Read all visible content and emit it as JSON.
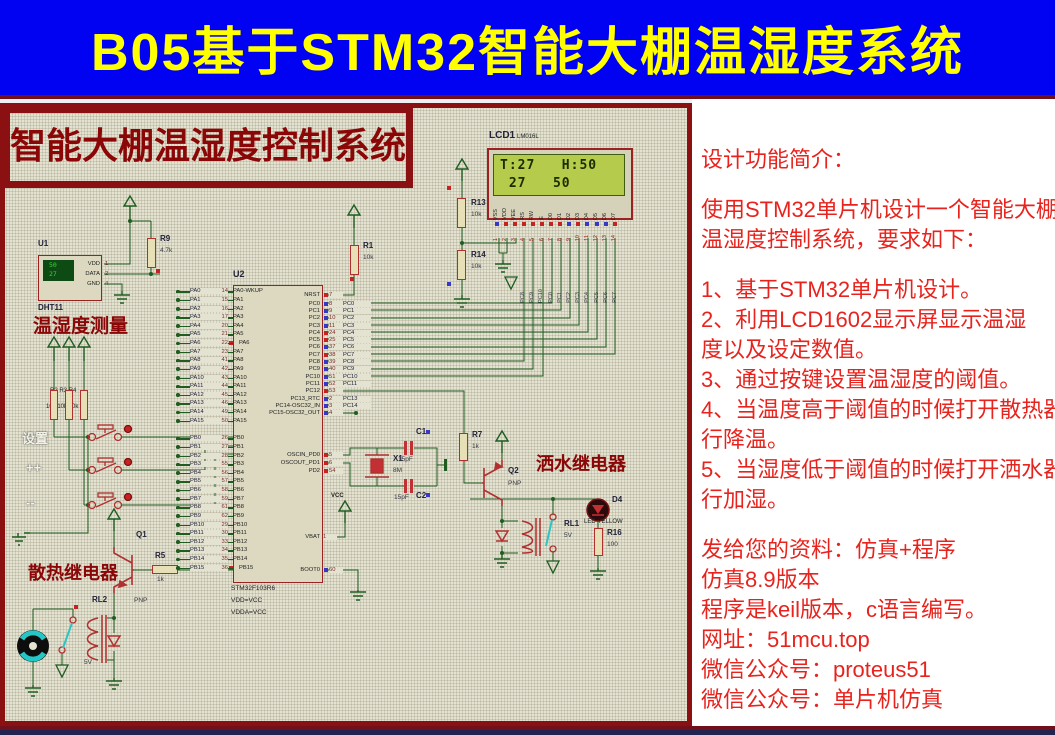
{
  "banner": {
    "title": "B05基于STM32智能大棚温湿度系统"
  },
  "colors": {
    "banner_bg": "#0202f2",
    "banner_text": "#ffff00",
    "maroon": "#8a1012",
    "accent_red": "#e8231d",
    "wire_green": "#1e5c20",
    "lcd_screen": "#b5cb4c",
    "navy_bar": "#232350",
    "state_high": "#c62222",
    "state_low": "#3838c6"
  },
  "schematic": {
    "board_title": "智能大棚温湿度控制系统",
    "sections": {
      "measure": "温湿度测量",
      "heat_relay": "散热继电器",
      "spray_relay": "洒水继电器"
    },
    "keys": {
      "set": "设置",
      "plus": "++",
      "minus": "--"
    },
    "dht11": {
      "ref": "U1",
      "part": "DHT11",
      "display_top": "50",
      "display_bottom": "27",
      "pins": [
        {
          "name": "VDD",
          "num": "1"
        },
        {
          "name": "DATA",
          "num": "2"
        },
        {
          "name": "GND",
          "num": "4"
        }
      ]
    },
    "parts": {
      "r9": {
        "ref": "R9",
        "value": "4.7k"
      },
      "r1": {
        "ref": "R1",
        "value": "10k"
      },
      "r13": {
        "ref": "R13",
        "value": "10k"
      },
      "r14": {
        "ref": "R14",
        "value": "10k"
      },
      "r5": {
        "ref": "R5",
        "value": "1k"
      },
      "r7": {
        "ref": "R7",
        "value": "1k"
      },
      "r16": {
        "ref": "R16",
        "value": "100"
      },
      "q1": {
        "ref": "Q1",
        "type": "PNP"
      },
      "q2": {
        "ref": "Q2",
        "type": "PNP"
      },
      "rl1": {
        "ref": "RL1",
        "value": "5V"
      },
      "rl2": {
        "ref": "RL2",
        "value": "5V"
      },
      "d4": {
        "ref": "D4",
        "part": "LED-YELLOW"
      },
      "x1": {
        "ref": "X1",
        "value": "8M"
      },
      "c1": {
        "ref": "C1",
        "value": "15pF"
      },
      "c2": {
        "ref": "C2",
        "value": "15pF"
      },
      "pullups": {
        "refs": "R2 R3 R4",
        "values": "10k 10k 10k"
      }
    },
    "vcc_label": "VCC",
    "mcu": {
      "ref": "U2",
      "part": "STM32F103R6",
      "notes": [
        "VDD=VCC",
        "VDDA=VCC"
      ],
      "pa_pins": [
        {
          "net": "PA0",
          "num": "14",
          "name": "PA0-WKUP",
          "s": ""
        },
        {
          "net": "PA1",
          "num": "15",
          "name": "PA1",
          "s": ""
        },
        {
          "net": "PA2",
          "num": "16",
          "name": "PA2",
          "s": ""
        },
        {
          "net": "PA3",
          "num": "17",
          "name": "PA3",
          "s": ""
        },
        {
          "net": "PA4",
          "num": "20",
          "name": "PA4",
          "s": ""
        },
        {
          "net": "PA5",
          "num": "21",
          "name": "PA5",
          "s": ""
        },
        {
          "net": "PA6",
          "num": "22",
          "name": "PA6",
          "s": "r"
        },
        {
          "net": "PA7",
          "num": "23",
          "name": "PA7",
          "s": ""
        },
        {
          "net": "PA8",
          "num": "41",
          "name": "PA8",
          "s": ""
        },
        {
          "net": "PA9",
          "num": "42",
          "name": "PA9",
          "s": ""
        },
        {
          "net": "PA10",
          "num": "43",
          "name": "PA10",
          "s": ""
        },
        {
          "net": "PA11",
          "num": "44",
          "name": "PA11",
          "s": ""
        },
        {
          "net": "PA12",
          "num": "45",
          "name": "PA12",
          "s": ""
        },
        {
          "net": "PA13",
          "num": "46",
          "name": "PA13",
          "s": ""
        },
        {
          "net": "PA14",
          "num": "49",
          "name": "PA14",
          "s": ""
        },
        {
          "net": "PA15",
          "num": "50",
          "name": "PA15",
          "s": ""
        }
      ],
      "pb_pins": [
        {
          "net": "PB0",
          "num": "26",
          "name": "PB0",
          "s": ""
        },
        {
          "net": "PB1",
          "num": "27",
          "name": "PB1",
          "s": ""
        },
        {
          "net": "PB2",
          "num": "28",
          "name": "PB2",
          "s": ""
        },
        {
          "net": "PB3",
          "num": "55",
          "name": "PB3",
          "s": ""
        },
        {
          "net": "PB4",
          "num": "56",
          "name": "PB4",
          "s": ""
        },
        {
          "net": "PB5",
          "num": "57",
          "name": "PB5",
          "s": ""
        },
        {
          "net": "PB6",
          "num": "58",
          "name": "PB6",
          "s": ""
        },
        {
          "net": "PB7",
          "num": "59",
          "name": "PB7",
          "s": ""
        },
        {
          "net": "PB8",
          "num": "61",
          "name": "PB8",
          "s": ""
        },
        {
          "net": "PB9",
          "num": "62",
          "name": "PB9",
          "s": ""
        },
        {
          "net": "PB10",
          "num": "29",
          "name": "PB10",
          "s": ""
        },
        {
          "net": "PB11",
          "num": "30",
          "name": "PB11",
          "s": ""
        },
        {
          "net": "PB12",
          "num": "33",
          "name": "PB12",
          "s": ""
        },
        {
          "net": "PB13",
          "num": "34",
          "name": "PB13",
          "s": ""
        },
        {
          "net": "PB14",
          "num": "35",
          "name": "PB14",
          "s": ""
        },
        {
          "net": "PB15",
          "num": "36",
          "name": "PB15",
          "s": "r"
        }
      ],
      "nrst": {
        "name": "NRST",
        "num": "7",
        "net": "",
        "s": "r"
      },
      "pc_pins": [
        {
          "name": "PC0",
          "num": "8",
          "net": "PC0",
          "s": "b"
        },
        {
          "name": "PC1",
          "num": "9",
          "net": "PC1",
          "s": "b"
        },
        {
          "name": "PC2",
          "num": "10",
          "net": "PC2",
          "s": "b"
        },
        {
          "name": "PC3",
          "num": "11",
          "net": "PC3",
          "s": "b"
        },
        {
          "name": "PC4",
          "num": "24",
          "net": "PC4",
          "s": "r"
        },
        {
          "name": "PC5",
          "num": "25",
          "net": "PC5",
          "s": "r"
        },
        {
          "name": "PC6",
          "num": "37",
          "net": "PC6",
          "s": "b"
        },
        {
          "name": "PC7",
          "num": "38",
          "net": "PC7",
          "s": "r"
        },
        {
          "name": "PC8",
          "num": "39",
          "net": "PC8",
          "s": "b"
        },
        {
          "name": "PC9",
          "num": "40",
          "net": "PC9",
          "s": "b"
        },
        {
          "name": "PC10",
          "num": "51",
          "net": "PC10",
          "s": "b"
        },
        {
          "name": "PC11",
          "num": "52",
          "net": "PC11",
          "s": "b"
        },
        {
          "name": "PC12",
          "num": "53",
          "net": "",
          "s": "r"
        },
        {
          "name": "PC13_RTC",
          "num": "2",
          "net": "PC13",
          "s": "b"
        },
        {
          "name": "PC14-OSC32_IN",
          "num": "3",
          "net": "PC14",
          "s": "b"
        },
        {
          "name": "PC15-OSC32_OUT",
          "num": "4",
          "net": "",
          "s": "b"
        }
      ],
      "osc_pins": [
        {
          "name": "OSCIN_PD0",
          "num": "5",
          "net": "",
          "s": "r"
        },
        {
          "name": "OSCOUT_PD1",
          "num": "6",
          "net": "",
          "s": "r"
        },
        {
          "name": "PD2",
          "num": "54",
          "net": "",
          "s": "r"
        }
      ],
      "vbat": {
        "name": "VBAT",
        "num": "1",
        "net": "",
        "s": ""
      },
      "boot": {
        "name": "BOOT0",
        "num": "60",
        "net": "",
        "s": "b"
      }
    },
    "lcd": {
      "ref": "LCD1",
      "part": "LM016L",
      "line1": "T:27   H:50",
      "line2": " 27   50",
      "pins": [
        {
          "name": "VSS",
          "num": "1",
          "s": "b"
        },
        {
          "name": "VDD",
          "num": "2",
          "s": "r"
        },
        {
          "name": "VEE",
          "num": "3",
          "s": "r"
        },
        {
          "name": "RS",
          "num": "4",
          "s": "r"
        },
        {
          "name": "RW",
          "num": "5",
          "s": "r"
        },
        {
          "name": "E",
          "num": "6",
          "s": "r"
        },
        {
          "name": "D0",
          "num": "7",
          "s": "r"
        },
        {
          "name": "D1",
          "num": "8",
          "s": "r"
        },
        {
          "name": "D2",
          "num": "9",
          "s": "b"
        },
        {
          "name": "D3",
          "num": "10",
          "s": "r"
        },
        {
          "name": "D4",
          "num": "11",
          "s": "b"
        },
        {
          "name": "D5",
          "num": "12",
          "s": "b"
        },
        {
          "name": "D6",
          "num": "13",
          "s": "b"
        },
        {
          "name": "D7",
          "num": "14",
          "s": "r"
        }
      ],
      "nets_rse": [
        "PC8",
        "PC9",
        "PC10"
      ],
      "nets_d": [
        "PC0",
        "PC1",
        "PC2",
        "PC3",
        "PC4",
        "PC5",
        "PC6",
        "PC7"
      ]
    }
  },
  "info_panel": {
    "lines": [
      "设计功能简介：",
      "",
      "使用STM32单片机设计一个智能大棚",
      "温湿度控制系统，要求如下：",
      "",
      "1、基于STM32单片机设计。",
      "2、利用LCD1602显示屏显示温湿",
      "度以及设定数值。",
      "3、通过按键设置温湿度的阈值。",
      "4、当温度高于阈值的时候打开散热器进",
      "行降温。",
      "5、当湿度低于阈值的时候打开洒水器进",
      "行加湿。",
      "",
      "发给您的资料：仿真+程序",
      "仿真8.9版本",
      "程序是keil版本，c语言编写。",
      "网址：51mcu.top",
      "微信公众号：proteus51",
      "微信公众号：单片机仿真"
    ]
  }
}
